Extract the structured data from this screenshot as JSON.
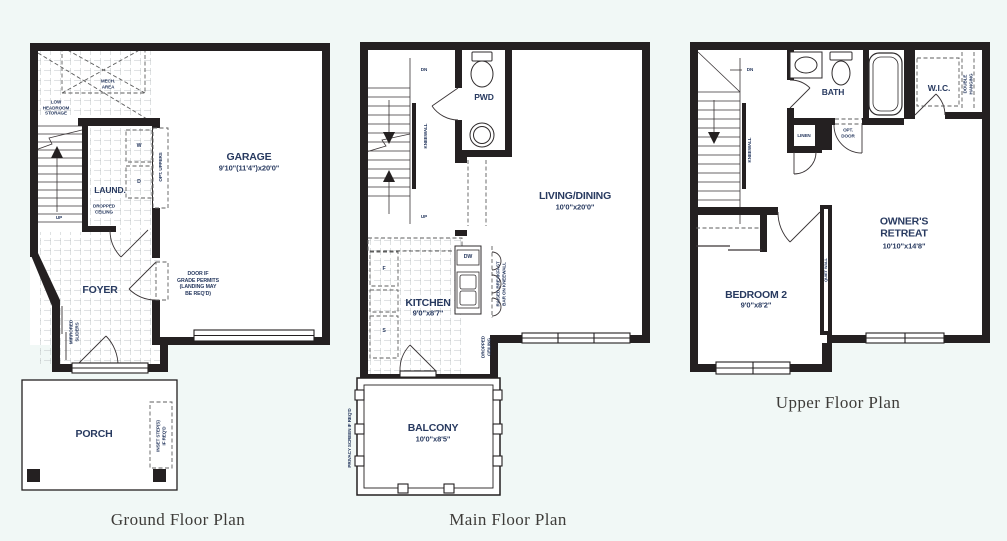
{
  "palette": {
    "background": "#f1f8f6",
    "wall": "#242021",
    "label_ink": "#283a60",
    "caption_ink": "#3e3c39"
  },
  "ground": {
    "caption": "Ground Floor Plan",
    "mech_area": "MECH.\nAREA",
    "low_headroom": "LOW\nHEADROOM\nSTORAGE",
    "garage_name": "GARAGE",
    "garage_dims": "9'10\"(11'4\")x20'0\"",
    "laundry": "LAUND.",
    "washer": "W",
    "dryer": "D",
    "opt_uppers": "OPT. UPPERS",
    "dropped_ceiling": "DROPPED\nCEILING",
    "up": "UP",
    "foyer": "FOYER",
    "door_note": "DOOR IF\nGRADE PERMITS\n(LANDING MAY\nBE REQ'D)",
    "mirrored_sliders": "MIRRORED\nSLIDERS",
    "porch": "PORCH",
    "inset_steps": "INSET STEP(S)\nIF REQ'D"
  },
  "main": {
    "caption": "Main Floor Plan",
    "dn": "DN",
    "up": "UP",
    "kneewall": "KNEEWALL",
    "pwd": "PWD",
    "living_name": "LIVING/DINING",
    "living_dims": "10'0\"x20'0\"",
    "kitchen_name": "KITCHEN",
    "kitchen_dims": "9'0\"x8'7\"",
    "fridge": "F",
    "stove": "S",
    "dishwasher": "DW",
    "breakfast_bar": "RAISED BREAKFAST\nBAR ON KNEEWALL",
    "dropped_ceiling": "DROPPED\nCEILING",
    "balcony_name": "BALCONY",
    "balcony_dims": "10'0\"x8'5\"",
    "privacy": "PRIVACY SCREEN IF REQ'D"
  },
  "upper": {
    "caption": "Upper Floor Plan",
    "dn": "DN",
    "kneewall": "KNEEWALL",
    "bath": "BATH",
    "wic": "W.I.C.",
    "double_hanging": "DOUBLE HANGING",
    "linen": "LINEN",
    "opt_door": "OPT.\nDOOR",
    "owners_name": "OWNER'S\nRETREAT",
    "owners_dims": "10'10\"x14'8\"",
    "bedroom2_name": "BEDROOM 2",
    "bedroom2_dims": "9'0\"x8'2\"",
    "quiet_wall": "QUIET WALL"
  }
}
